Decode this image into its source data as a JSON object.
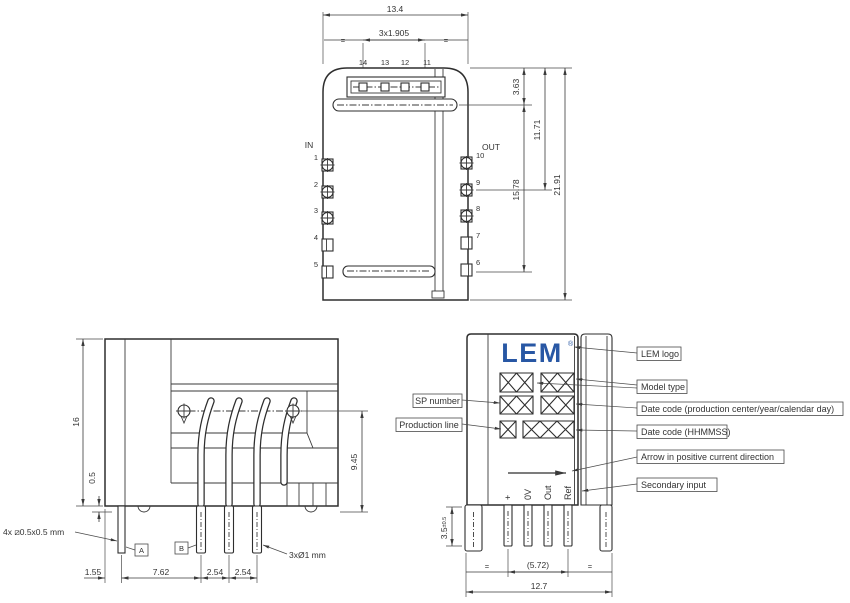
{
  "top_view": {
    "label_in": "IN",
    "label_out": "OUT",
    "top_pins": [
      "14",
      "13",
      "12",
      "11"
    ],
    "left_pins": [
      "1",
      "2",
      "3",
      "4",
      "5"
    ],
    "right_pins": [
      "10",
      "9",
      "8",
      "7",
      "6"
    ],
    "dim_width": "13.4",
    "dim_pitch": "3x1.905",
    "eq": "=",
    "dim_3_63": "3.63",
    "dim_11_71": "11.71",
    "dim_15_78": "15.78",
    "dim_21_91": "21.91"
  },
  "front_view": {
    "dim_height": "16",
    "dim_standoff": "0.5",
    "dim_lead": "9.45",
    "dim_1_55": "1.55",
    "dim_7_62": "7.62",
    "dim_2_54_a": "2.54",
    "dim_2_54_b": "2.54",
    "note_square_pins": "4x ⧄0.5x0.5 mm",
    "datum_a": "A",
    "datum_b": "B",
    "note_round_pins": "3xØ1 mm"
  },
  "side_view": {
    "logo": "LEM",
    "logo_reg": "®",
    "pins": [
      "+",
      "0V",
      "Out",
      "Ref"
    ],
    "dim_pin_len": "3.5",
    "dim_pin_tol": "±0.5",
    "dim_span": "(5.72)",
    "dim_width": "12.7",
    "eq": "=",
    "callout_sp": "SP number",
    "callout_prod": "Production line",
    "callout_logo": "LEM logo",
    "callout_model": "Model type",
    "callout_date1": "Date code (production center/year/calendar day)",
    "callout_date2": "Date code (HHMMSS)",
    "callout_arrow": "Arrow in positive current direction",
    "callout_secondary": "Secondary input"
  },
  "colors": {
    "line": "#3a3a3a",
    "text": "#333333",
    "logo_blue": "#2857A4"
  }
}
